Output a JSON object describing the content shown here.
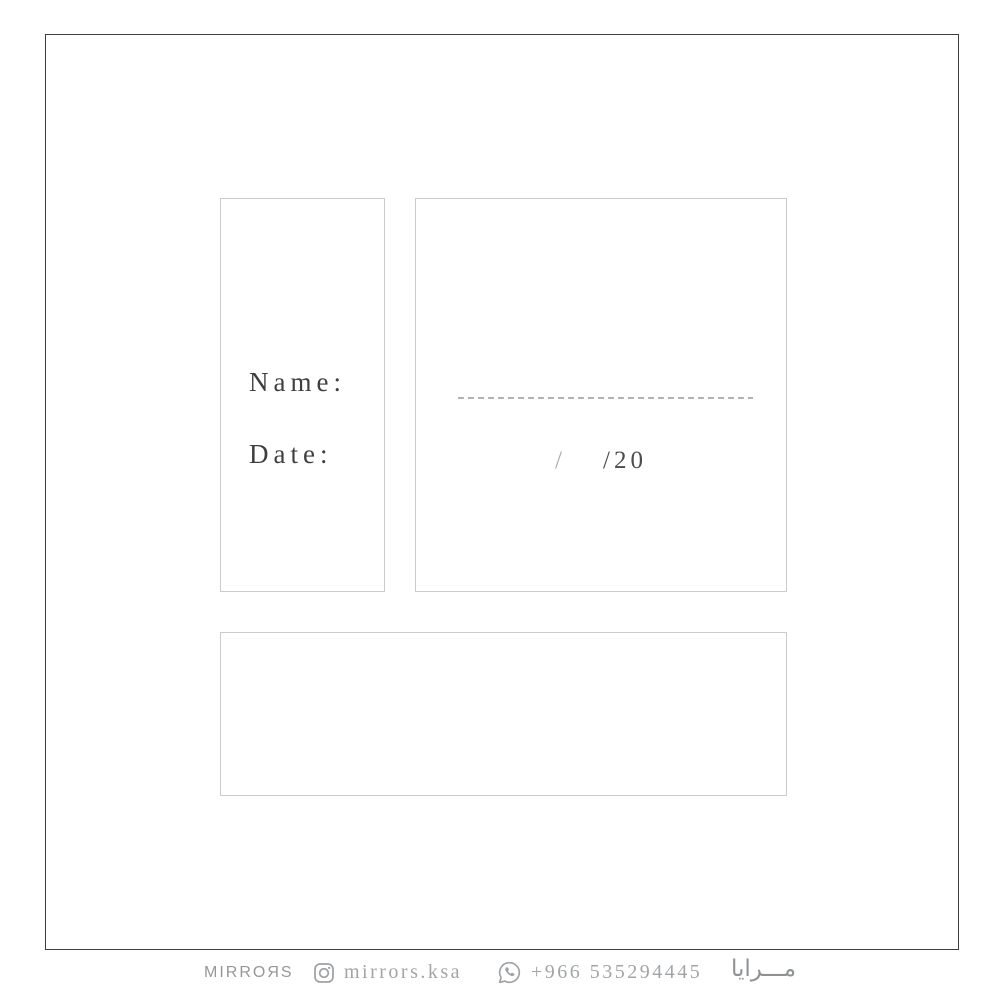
{
  "card": {
    "labels": {
      "name": "Name:",
      "date": "Date:"
    },
    "date_placeholder": {
      "day_slash": "/",
      "year": "/20"
    }
  },
  "footer": {
    "brand_logo": "MIRROЯS",
    "instagram": {
      "icon": "instagram-icon",
      "handle": "mirrors.ksa"
    },
    "whatsapp": {
      "icon": "whatsapp-icon",
      "phone": "+966 535294445"
    },
    "brand_arabic": "مـــرايا"
  },
  "colors": {
    "background": "#ffffff",
    "frame_border": "#3e3e3e",
    "box_border": "#cbcbcb",
    "label_text": "#3f3f3f",
    "dash_line": "#b3b3b3",
    "footer_text": "#a2a5a7",
    "year_text": "#4c4c4c"
  }
}
